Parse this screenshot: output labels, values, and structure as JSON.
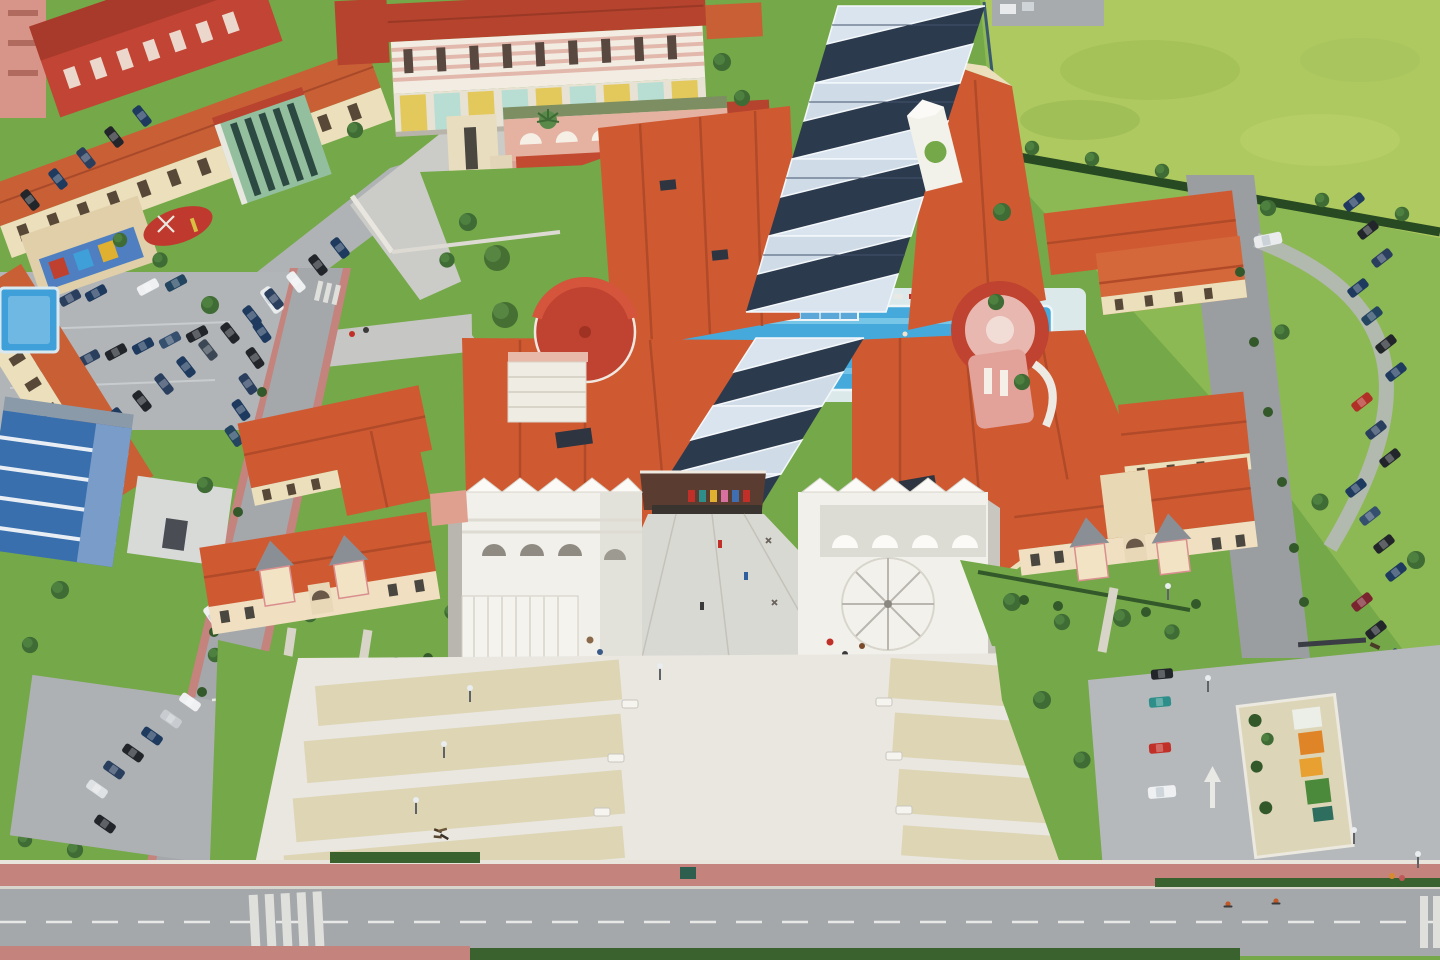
{
  "scene": {
    "kind": "aerial-photograph",
    "setting": "seaside holiday resort village: central pool complex with zigzag glass skylight wings, terracotta-roofed apartment rows, detached villas, lawns, car parks and access roads",
    "road_markings": {
      "stop": "STOP"
    },
    "palette": {
      "lawn": "#74a848",
      "meadow": "#aec95f",
      "terracotta_roof": "#c9572f",
      "dark_red_roof": "#b5432e",
      "cream_wall": "#ecdfbc",
      "skylight_dark": "#35455c",
      "skylight_glass": "#d9e4ee",
      "pool_water": "#45aadb",
      "pool_deck": "#dce9ea",
      "asphalt": "#a4a8ab",
      "plaza_concrete": "#e9e7e0",
      "gravel": "#ded5b5",
      "pink_sidewalk": "#c5837d",
      "white_pavilion": "#f1f0ea",
      "green_tower": "#93bf9e",
      "pink_building": "#e2a29a",
      "blue_building": "#3a6fae",
      "car_navy": "#1e3a5e",
      "car_black": "#22262b",
      "car_white": "#eef0f2",
      "car_red": "#c03028",
      "car_teal": "#2e8f8a",
      "hedge": "#2c4f24",
      "tree": "#3f6b35"
    }
  }
}
